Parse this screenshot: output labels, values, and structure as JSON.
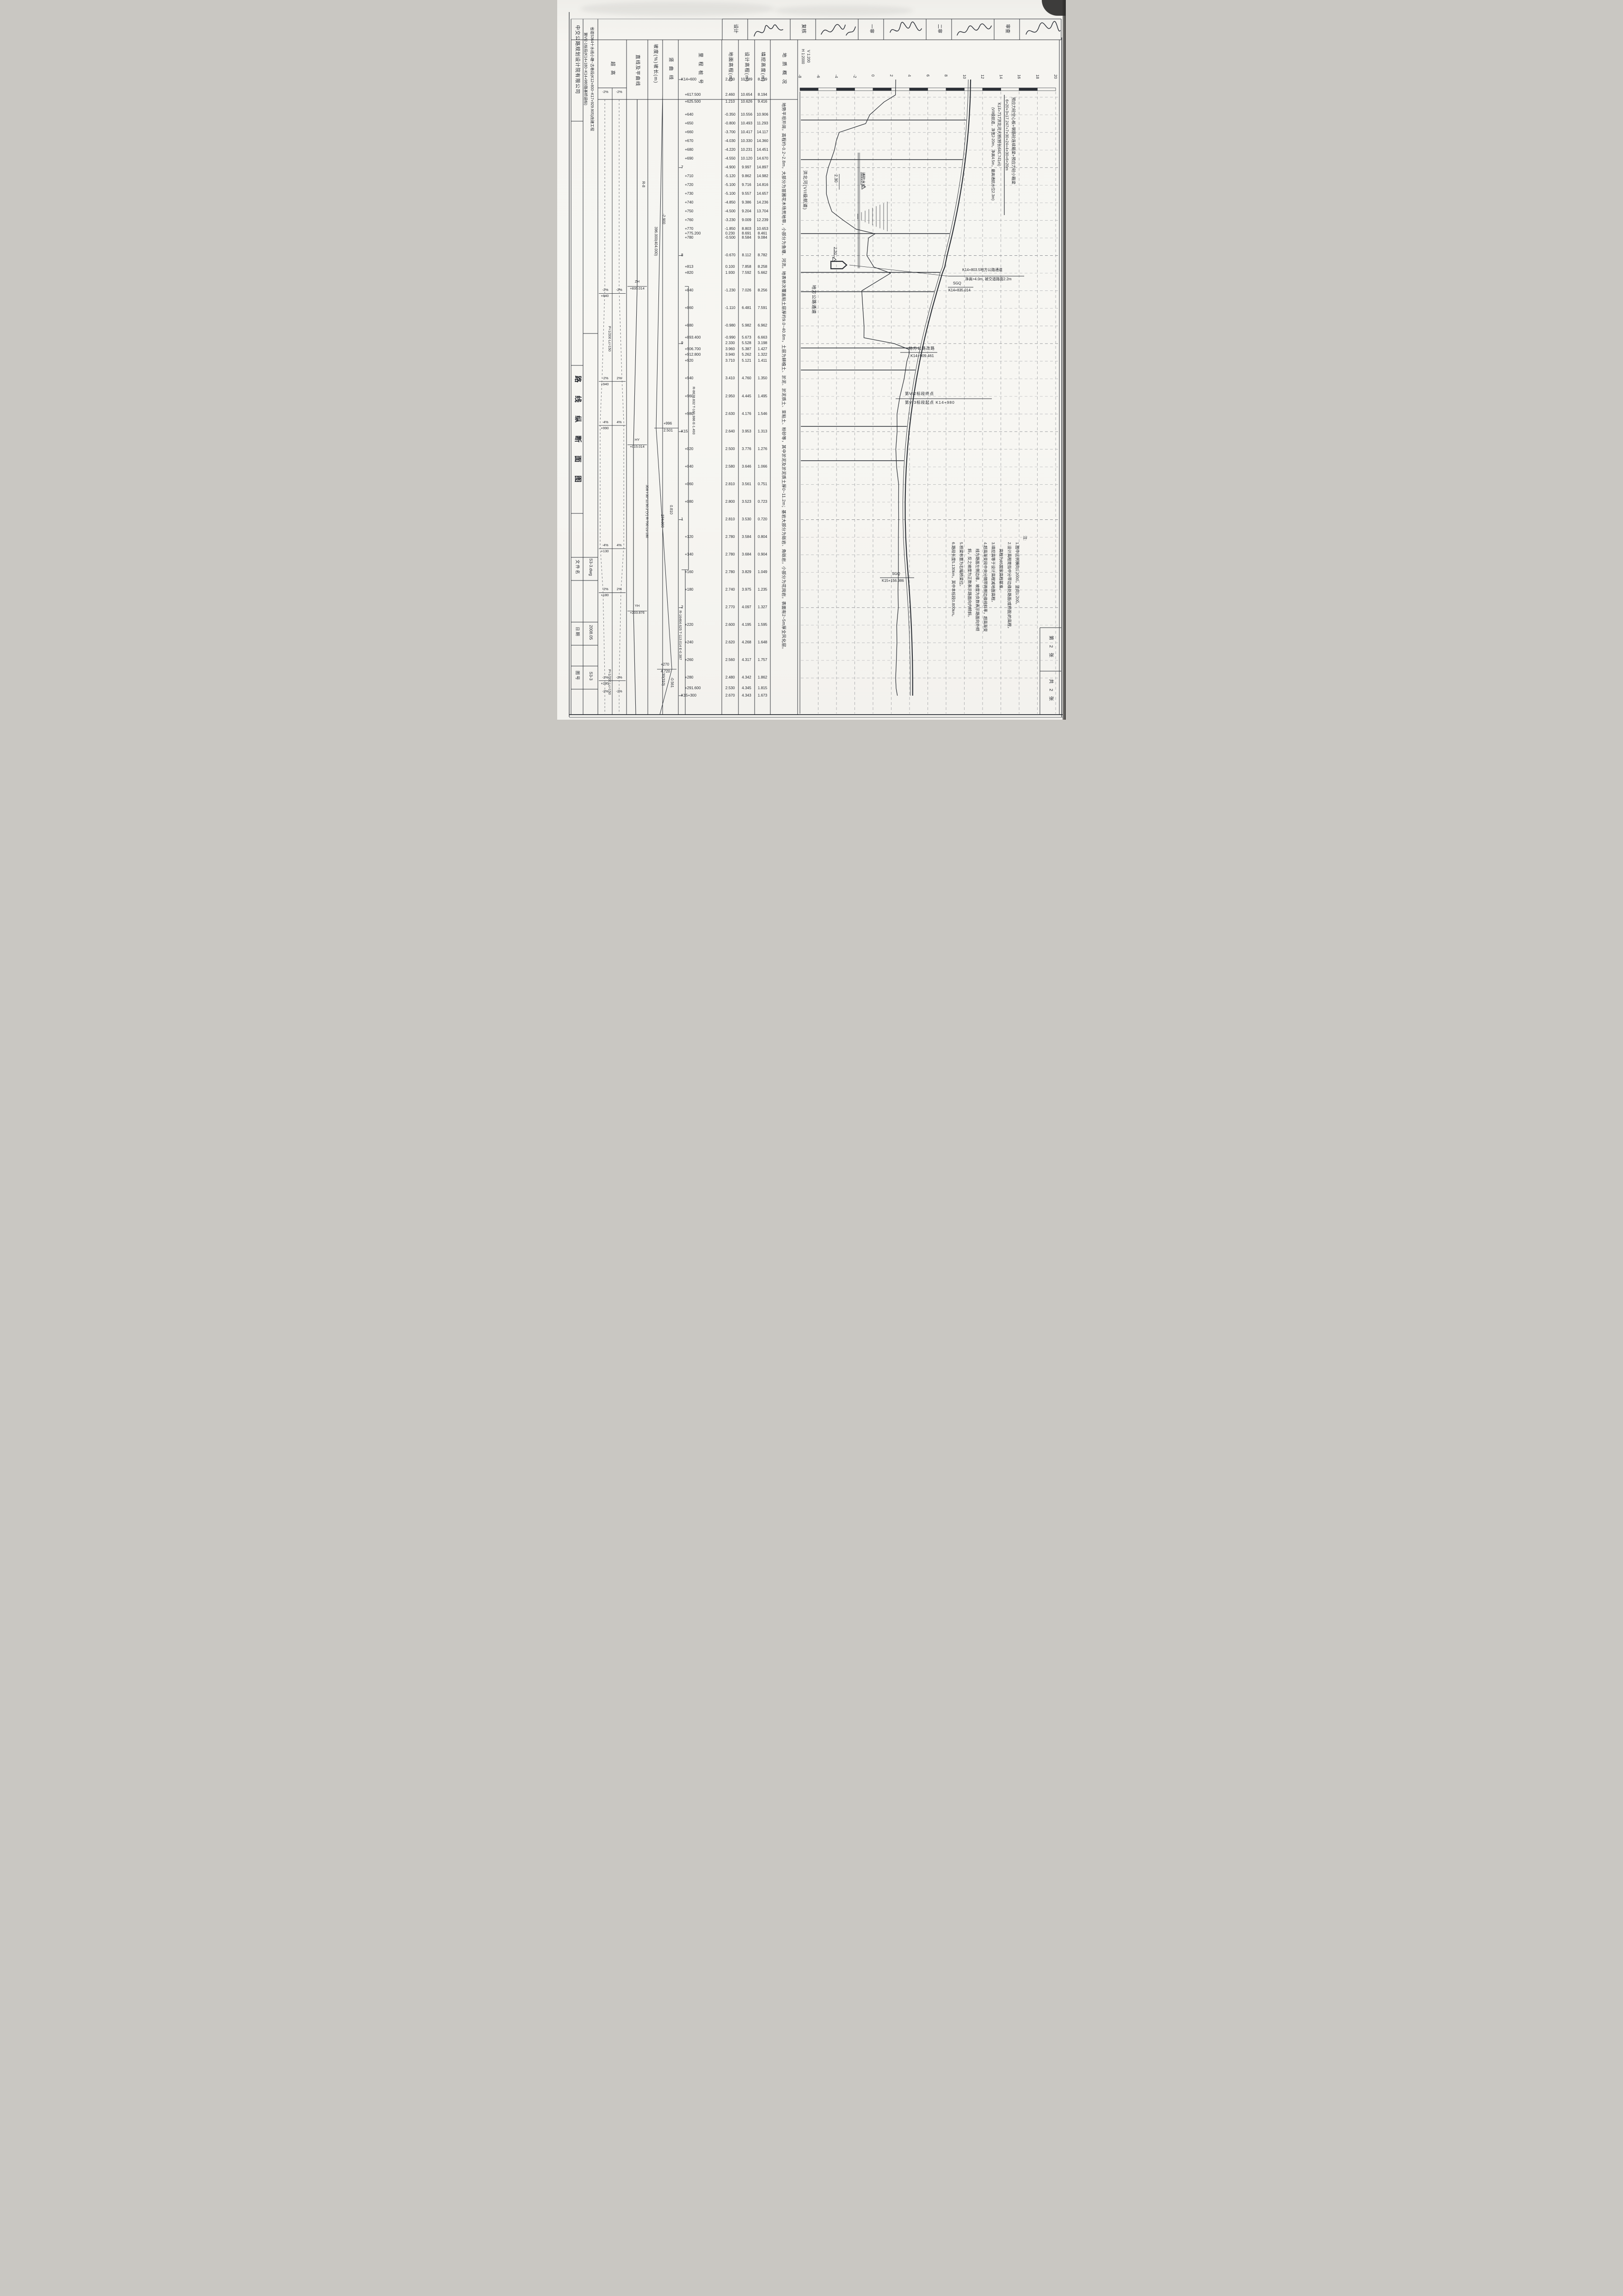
{
  "approval": {
    "labels": [
      "设计",
      "复核",
      "一审",
      "二审",
      "审查"
    ],
    "signature_icon": "handwritten-signature-scribble"
  },
  "title_block": {
    "company": "中交公路规划设计院有限公司",
    "project_line1": "省道S364十水线小塘~古巷段(K12+800~K17+929.905)改建工程",
    "project_line2": "第VI2-1标段(K14+180~K14+980路基桥涵标)",
    "drawing_title": "路 线 纵 断 面 图",
    "file_label": "文件名",
    "file_value": "S3-3.dwg",
    "date_label": "日期",
    "date_value": "2008.05",
    "sheet_label": "图号",
    "sheet_value": "S3-3",
    "sheet_current": "第 2 张",
    "sheet_total": "共 2 张"
  },
  "scale_note": {
    "horizontal": "H 1:2000",
    "vertical": "V 1:200"
  },
  "band_headers": [
    "超高",
    "直线及平曲线",
    "坡度(%)坡长(m)",
    "竖曲线",
    "里程桩号",
    "地面高程(m)",
    "设计高程(m)",
    "填挖高度(m)",
    "地质概况"
  ],
  "geology_text": "地势平坦开阔，高程约-0.2~2.8m，大部分为苗圃花木场荒地带，小部分为鱼塘、河流。地表依次覆盖粘土层厚约9.0~40.8m，土层为耕植土、淤泥、淤泥质土、亚粘土、粉砂等，其中淤泥及淤泥质土厚0~11.2m；基岩大部分为砾岩、角砾岩，小部分为花岗岩，表面有2~5m厚全风化层。",
  "superelevation": {
    "events": [
      {
        "sta": 618,
        "left": "-2%",
        "right": "-2%"
      },
      {
        "sta": 843,
        "left": "-2%",
        "right": "-2%",
        "label": "+840"
      },
      {
        "sta": 943,
        "left": "-2%",
        "right": "2%",
        "label": "+940"
      },
      {
        "sta": 993,
        "left": "-4%",
        "right": "4%",
        "label": "+990"
      },
      {
        "sta": 1133,
        "left": "-4%",
        "right": "4%",
        "label": "+130"
      },
      {
        "sta": 1183,
        "left": "-2%",
        "right": "2%",
        "label": "+180"
      },
      {
        "sta": 1283,
        "left": "-2%",
        "right": "-2%",
        "label": "+280"
      },
      {
        "sta": 1299,
        "left": "-2%",
        "right": "-2%"
      }
    ],
    "transition_notes": [
      {
        "text": "P=1/200  Lc=150",
        "sta": 882
      },
      {
        "text": "P=1/200  Lc=150",
        "sta": 1272
      }
    ]
  },
  "alignment": {
    "r_note": "R-8",
    "points": [
      {
        "code": "ZH",
        "value": "+835.014",
        "sta": 835.014
      },
      {
        "code": "HY",
        "value": "+015.014",
        "sta": 1015.014
      },
      {
        "code": "YH",
        "value": "+203.876",
        "sta": 1203.876
      }
    ],
    "curve_note": "JD8  I-30°11′30.2″(Y)  R-700  Ls-180"
  },
  "grades": {
    "segments": [
      {
        "grade": "-2.900",
        "length": "396.000(404.000)"
      },
      {
        "grade": "0.810",
        "length": "274.000"
      },
      {
        "grade": "-0.561",
        "length": "30(310)"
      }
    ],
    "pvi": [
      {
        "station_label": "+996",
        "elevation": "2.501",
        "sta": 996
      },
      {
        "station_label": "+270",
        "elevation": "4.720",
        "sta": 1270
      }
    ]
  },
  "vertical_curves": [
    {
      "text": "R-8678.832 T-160.986 E-1.493",
      "from_sta": 835,
      "to_sta": 1157
    },
    {
      "text": "R-16464.625 T-113.014 E-0.387",
      "from_sta": 1157,
      "to_sta": 1383
    }
  ],
  "chart_data": {
    "type": "line",
    "title": "路线纵断面图",
    "scale": {
      "horizontal": "1:2000",
      "vertical": "1:200"
    },
    "elevation_axis": {
      "min": -8,
      "max": 20,
      "step": 2,
      "unit": "m"
    },
    "series_names": [
      "地面高程",
      "设计高程"
    ],
    "rows": [
      {
        "label": "K14+600",
        "sta": 600,
        "ground": "2.490",
        "design": "10.689",
        "cutfill": "8.199"
      },
      {
        "label": "+617.500",
        "sta": 617.5,
        "ground": "2.460",
        "design": "10.654",
        "cutfill": "8.194"
      },
      {
        "label": "+625.500",
        "sta": 625.5,
        "ground": "1.210",
        "design": "10.626",
        "cutfill": "9.416"
      },
      {
        "label": "+640",
        "sta": 640,
        "ground": "-0.350",
        "design": "10.556",
        "cutfill": "10.906"
      },
      {
        "label": "+650",
        "sta": 650,
        "ground": "-0.800",
        "design": "10.493",
        "cutfill": "11.293"
      },
      {
        "label": "+660",
        "sta": 660,
        "ground": "-3.700",
        "design": "10.417",
        "cutfill": "14.117"
      },
      {
        "label": "+670",
        "sta": 670,
        "ground": "-4.030",
        "design": "10.330",
        "cutfill": "14.360"
      },
      {
        "label": "+680",
        "sta": 680,
        "ground": "-4.220",
        "design": "10.231",
        "cutfill": "14.451"
      },
      {
        "label": "+690",
        "sta": 690,
        "ground": "-4.550",
        "design": "10.120",
        "cutfill": "14.670"
      },
      {
        "label": "7",
        "sta": 700,
        "ground": "-4.900",
        "design": "9.997",
        "cutfill": "14.897"
      },
      {
        "label": "+710",
        "sta": 710,
        "ground": "-5.120",
        "design": "9.862",
        "cutfill": "14.982"
      },
      {
        "label": "+720",
        "sta": 720,
        "ground": "-5.100",
        "design": "9.716",
        "cutfill": "14.816"
      },
      {
        "label": "+730",
        "sta": 730,
        "ground": "-5.100",
        "design": "9.557",
        "cutfill": "14.657"
      },
      {
        "label": "+740",
        "sta": 740,
        "ground": "-4.850",
        "design": "9.386",
        "cutfill": "14.236"
      },
      {
        "label": "+750",
        "sta": 750,
        "ground": "-4.500",
        "design": "9.204",
        "cutfill": "13.704"
      },
      {
        "label": "+760",
        "sta": 760,
        "ground": "-3.230",
        "design": "9.009",
        "cutfill": "12.239"
      },
      {
        "label": "+770",
        "sta": 770,
        "ground": "-1.850",
        "design": "8.803",
        "cutfill": "10.653"
      },
      {
        "label": "+775.200",
        "sta": 775.2,
        "ground": "0.230",
        "design": "8.691",
        "cutfill": "8.461"
      },
      {
        "label": "+780",
        "sta": 780,
        "ground": "-0.500",
        "design": "8.584",
        "cutfill": "9.084"
      },
      {
        "label": "8",
        "sta": 800,
        "ground": "-0.670",
        "design": "8.112",
        "cutfill": "8.782"
      },
      {
        "label": "+813",
        "sta": 813,
        "ground": "0.100",
        "design": "7.858",
        "cutfill": "8.258"
      },
      {
        "label": "+820",
        "sta": 820,
        "ground": "1.930",
        "design": "7.592",
        "cutfill": "5.662"
      },
      {
        "label": "+840",
        "sta": 840,
        "ground": "-1.230",
        "design": "7.026",
        "cutfill": "8.256"
      },
      {
        "label": "+860",
        "sta": 860,
        "ground": "-1.110",
        "design": "6.481",
        "cutfill": "7.591"
      },
      {
        "label": "+880",
        "sta": 880,
        "ground": "-0.980",
        "design": "5.982",
        "cutfill": "6.962"
      },
      {
        "label": "+893.400",
        "sta": 893.4,
        "ground": "-0.990",
        "design": "5.673",
        "cutfill": "6.663"
      },
      {
        "label": "9",
        "sta": 900,
        "ground": "2.330",
        "design": "5.528",
        "cutfill": "3.198"
      },
      {
        "label": "+906.700",
        "sta": 906.7,
        "ground": "3.960",
        "design": "5.387",
        "cutfill": "1.427"
      },
      {
        "label": "+912.800",
        "sta": 912.8,
        "ground": "3.940",
        "design": "5.262",
        "cutfill": "1.322"
      },
      {
        "label": "+920",
        "sta": 920,
        "ground": "3.710",
        "design": "5.121",
        "cutfill": "1.411"
      },
      {
        "label": "+940",
        "sta": 940,
        "ground": "3.410",
        "design": "4.760",
        "cutfill": "1.350"
      },
      {
        "label": "+960",
        "sta": 960,
        "ground": "2.950",
        "design": "4.445",
        "cutfill": "1.495"
      },
      {
        "label": "+980",
        "sta": 980,
        "ground": "2.630",
        "design": "4.176",
        "cutfill": "1.546"
      },
      {
        "label": "K15",
        "sta": 1000,
        "ground": "2.640",
        "design": "3.953",
        "cutfill": "1.313"
      },
      {
        "label": "+020",
        "sta": 1020,
        "ground": "2.500",
        "design": "3.776",
        "cutfill": "1.276"
      },
      {
        "label": "+040",
        "sta": 1040,
        "ground": "2.580",
        "design": "3.646",
        "cutfill": "1.066"
      },
      {
        "label": "+060",
        "sta": 1060,
        "ground": "2.810",
        "design": "3.561",
        "cutfill": "0.751"
      },
      {
        "label": "+080",
        "sta": 1080,
        "ground": "2.800",
        "design": "3.523",
        "cutfill": "0.723"
      },
      {
        "label": "1",
        "sta": 1100,
        "ground": "2.810",
        "design": "3.530",
        "cutfill": "0.720"
      },
      {
        "label": "+120",
        "sta": 1120,
        "ground": "2.780",
        "design": "3.584",
        "cutfill": "0.804"
      },
      {
        "label": "+140",
        "sta": 1140,
        "ground": "2.780",
        "design": "3.684",
        "cutfill": "0.904"
      },
      {
        "label": "+160",
        "sta": 1160,
        "ground": "2.780",
        "design": "3.829",
        "cutfill": "1.049"
      },
      {
        "label": "+180",
        "sta": 1180,
        "ground": "2.740",
        "design": "3.975",
        "cutfill": "1.235"
      },
      {
        "label": "2",
        "sta": 1200,
        "ground": "2.770",
        "design": "4.097",
        "cutfill": "1.327"
      },
      {
        "label": "+220",
        "sta": 1220,
        "ground": "2.600",
        "design": "4.195",
        "cutfill": "1.595"
      },
      {
        "label": "+240",
        "sta": 1240,
        "ground": "2.620",
        "design": "4.268",
        "cutfill": "1.648"
      },
      {
        "label": "+260",
        "sta": 1260,
        "ground": "2.560",
        "design": "4.317",
        "cutfill": "1.757"
      },
      {
        "label": "+280",
        "sta": 1280,
        "ground": "2.480",
        "design": "4.342",
        "cutfill": "1.862"
      },
      {
        "label": "+291.600",
        "sta": 1291.6,
        "ground": "2.530",
        "design": "4.345",
        "cutfill": "1.815"
      },
      {
        "label": "K15+300",
        "sta": 1300,
        "ground": "2.670",
        "design": "4.343",
        "cutfill": "1.673"
      }
    ],
    "piers_sta": [
      646,
      691,
      775,
      819,
      841,
      905,
      930,
      994,
      1033
    ],
    "river": {
      "label": "洪北河(VII级航道)",
      "nav_level_label": "通航水位",
      "nav_level": "2.30"
    },
    "underpass": {
      "level": "2.20"
    }
  },
  "annotations": {
    "bridge": {
      "line1": "预应力砼空心板+钢筋砼连续箱梁+预应力砼小箱梁",
      "line2": "6×20+3×17.247+7×30+24+4×30+6×20m",
      "line3": "K14+717洪北河大桥(桥长645.741m)",
      "line4": "(VII级航道，净宽2-20m，净高4.5m，最高通航水位2.3m)"
    },
    "local_road_label": "地方公路通道",
    "underpass_note": {
      "line1": "K14+803.5地方公路通道",
      "line2": "净高>4.0m, 被交道路面2.2m"
    },
    "sgq1": {
      "line1": "SGQ",
      "line2": "K14+835.014"
    },
    "road_change": {
      "line1": "地方公路改路",
      "line2": "K14+909.461"
    },
    "section_break": {
      "line1": "第VI2标段终点",
      "line2": "第VI3标段起点  K14+980"
    },
    "sgq2": {
      "line1": "SGQ",
      "line2": "K15+156.986"
    }
  },
  "notes": {
    "lines": [
      "注:",
      "1.图中比例横向1:2000，竖向1:200。",
      "2.设计高程是指中分带边缘处路面(或桥面)的高程，",
      "高程为85国家高程基准。",
      "3.填挖高等于设计高程减地面高程。",
      "4.超高渐变段中央分隔带两侧边缘线斜率，超高渐变",
      "线为路面左侧边缘，坡度为负数表示路面向外倾",
      "斜，反之坡度为正数表示路面向内倾斜。",
      "5.桥梁布置为右幅桥梁位。",
      "6.路段长度5.130km，其中本标段0.800km。"
    ]
  }
}
